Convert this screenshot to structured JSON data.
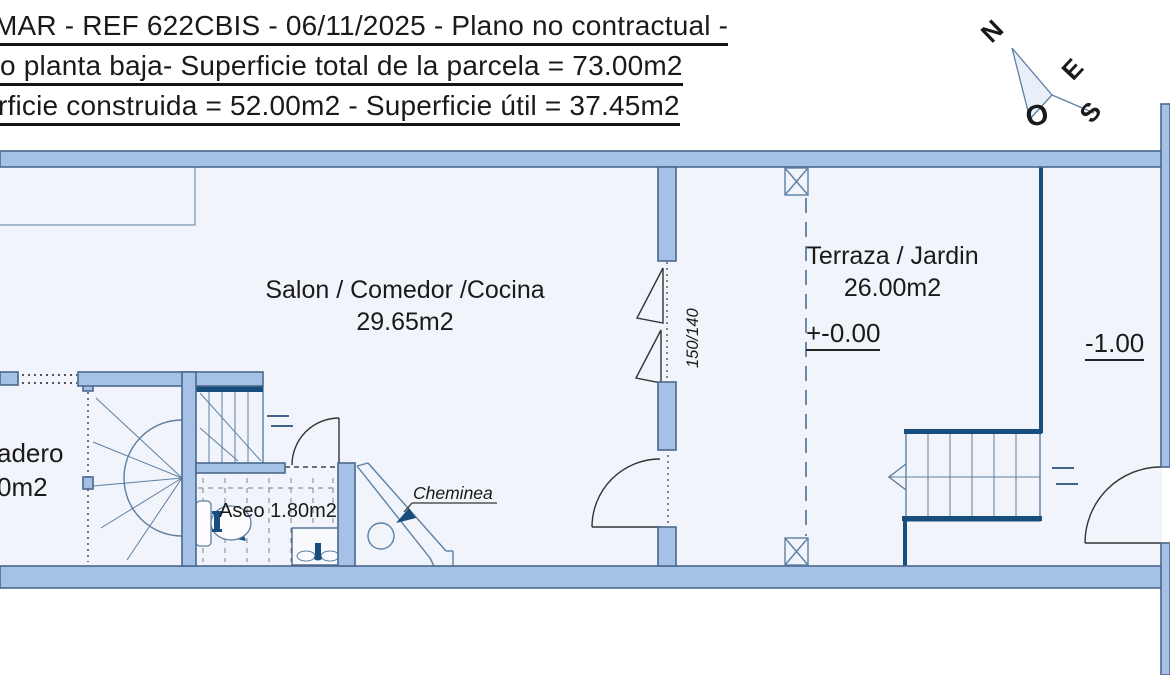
{
  "title": {
    "line1": "MAR - REF 622CBIS - 06/11/2025 - Plano no contractual -",
    "line2": "o planta baja- Superficie total de la parcela = 73.00m2",
    "line3": "rficie construida = 52.00m2 - Superficie útil = 37.45m2"
  },
  "compass": {
    "n": "N",
    "e": "E",
    "o": "O",
    "s": "S"
  },
  "rooms": {
    "salon": {
      "name": "Salon / Comedor /Cocina",
      "area": "29.65m2"
    },
    "terraza": {
      "name": "Terraza / Jardin",
      "area": "26.00m2",
      "level": "+-0.00"
    },
    "lavadero": {
      "name": "adero",
      "area": "0m2"
    },
    "aseo": {
      "label": "Aseo 1.80m2"
    }
  },
  "levels": {
    "exterior": "-1.00"
  },
  "annotations": {
    "cheminea": "Cheminea",
    "window_size": "150/140"
  },
  "colors": {
    "wall": "#a6c1e6",
    "outline": "#4a688e",
    "navy": "#174e7e",
    "line": "#5d7fa3",
    "interior": "#f1f4fa",
    "text": "#1a1a1a"
  }
}
